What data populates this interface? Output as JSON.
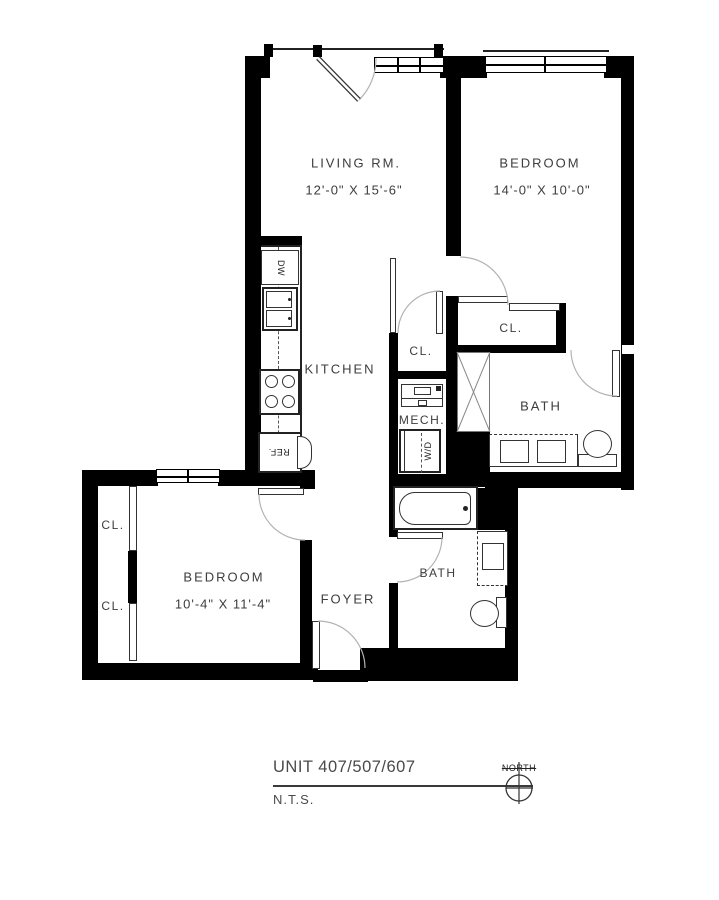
{
  "floorplan": {
    "rooms": {
      "living": {
        "label": "LIVING RM.",
        "dims": "12'-0\" X 15'-6\""
      },
      "bedroom1": {
        "label": "BEDROOM",
        "dims": "14'-0\" X 10'-0\""
      },
      "bedroom2": {
        "label": "BEDROOM",
        "dims": "10'-4\" X 11'-4\""
      },
      "kitchen": {
        "label": "KITCHEN"
      },
      "foyer": {
        "label": "FOYER"
      },
      "bath_upper": {
        "label": "BATH"
      },
      "bath_lower": {
        "label": "BATH"
      },
      "mech": {
        "label": "MECH."
      }
    },
    "closet_label": "CL.",
    "appliances": {
      "dishwasher": "DW",
      "refrigerator": "REF.",
      "washer_dryer": "W/D"
    }
  },
  "title_block": {
    "unit": "UNIT 407/507/607",
    "scale": "N.T.S.",
    "north_label": "NORTH"
  },
  "colors": {
    "wall": "#000000",
    "text": "#3d3d3d",
    "thin_line": "#333333",
    "arc": "#b3b3b3"
  }
}
